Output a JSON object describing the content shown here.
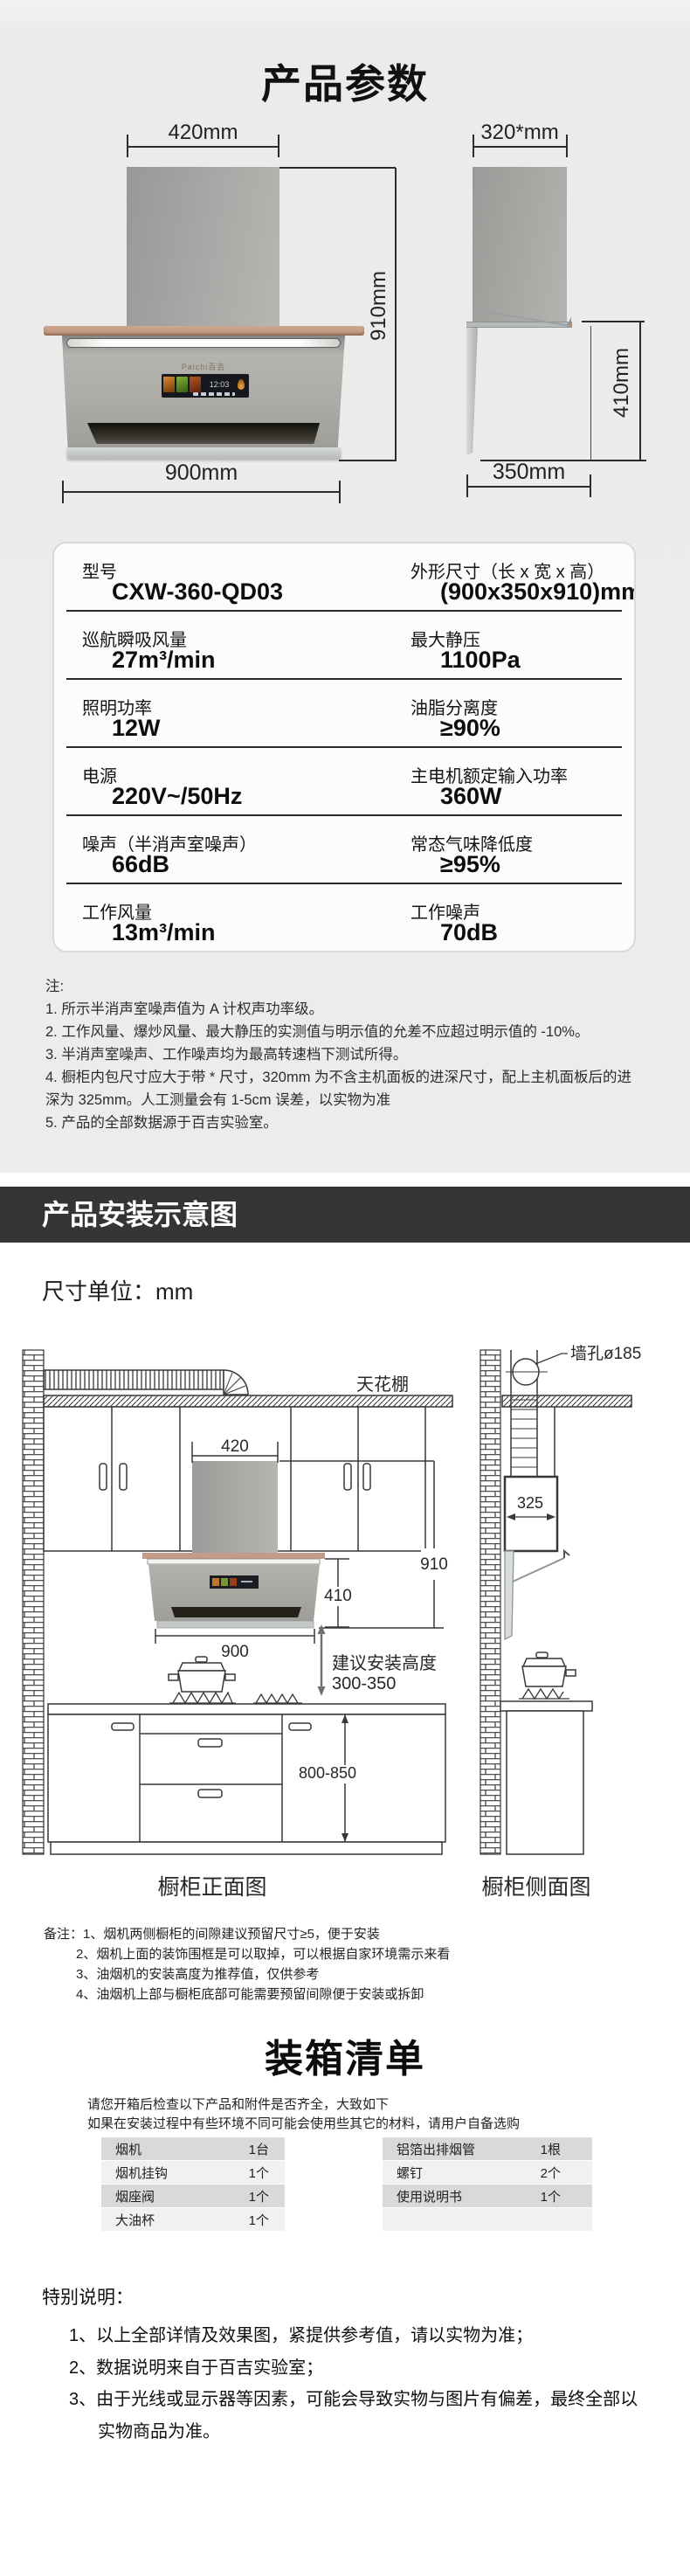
{
  "params": {
    "title": "产品参数",
    "front": {
      "top_dim": "420mm",
      "height_dim": "910mm",
      "width_dim": "900mm",
      "brand": "Paichi百吉",
      "clock": "12:03"
    },
    "side": {
      "top_dim": "320*mm",
      "height_dim": "410mm",
      "depth_dim": "350mm"
    },
    "table": {
      "rows": [
        {
          "ll": "型号",
          "lv": "CXW-360-QD03",
          "rl": "外形尺寸（长 x 宽 x 高）",
          "rv": "(900x350x910)mm"
        },
        {
          "ll": "巡航瞬吸风量",
          "lv": "27m³/min",
          "rl": "最大静压",
          "rv": "1100Pa"
        },
        {
          "ll": "照明功率",
          "lv": "12W",
          "rl": "油脂分离度",
          "rv": "≥90%"
        },
        {
          "ll": "电源",
          "lv": "220V~/50Hz",
          "rl": "主电机额定输入功率",
          "rv": "360W"
        },
        {
          "ll": "噪声（半消声室噪声）",
          "lv": "66dB",
          "rl": "常态气味降低度",
          "rv": "≥95%"
        },
        {
          "ll": "工作风量",
          "lv": "13m³/min",
          "rl": "工作噪声",
          "rv": "70dB"
        }
      ]
    },
    "notes_title": "注:",
    "notes": [
      "1. 所示半消声室噪声值为 A 计权声功率级。",
      "2. 工作风量、爆炒风量、最大静压的实测值与明示值的允差不应超过明示值的 -10%。",
      "3. 半消声室噪声、工作噪声均为最高转速档下测试所得。",
      "4. 橱柜内包尺寸应大于带 * 尺寸，320mm 为不含主机面板的进深尺寸，配上主机面板后的进深为 325mm。人工测量会有 1-5cm 误差，以实物为准",
      "5. 产品的全部数据源于百吉实验室。"
    ]
  },
  "install": {
    "banner": "产品安装示意图",
    "unit": "尺寸单位：mm",
    "ceiling": "天花棚",
    "wall_hole": "墙孔ø185",
    "duct_w": "420",
    "hood_h": "910",
    "body_h": "410",
    "hood_w": "900",
    "advise1": "建议安装高度",
    "advise2": "300-350",
    "counter_h": "800-850",
    "depth": "325",
    "front_caption": "橱柜正面图",
    "side_caption": "橱柜侧面图",
    "remarks_items": [
      "备注：1、烟机两侧橱柜的间隙建议预留尺寸≥5，便于安装",
      "2、烟机上面的装饰围框是可以取掉，可以根据自家环境需示来看",
      "3、油烟机的安装高度为推荐值，仅供参考",
      "4、油烟机上部与橱柜底部可能需要预留间隙便于安装或拆卸"
    ]
  },
  "packing": {
    "title": "装箱清单",
    "intro1": "请您开箱后检查以下产品和附件是否齐全，大致如下",
    "intro2": "如果在安装过程中有些环境不同可能会使用些其它的材料，请用户自备选购",
    "left_rows": [
      {
        "name": "烟机",
        "qty": "1台"
      },
      {
        "name": "烟机挂钩",
        "qty": "1个"
      },
      {
        "name": "烟座阀",
        "qty": "1个"
      },
      {
        "name": "大油杯",
        "qty": "1个"
      }
    ],
    "right_rows": [
      {
        "name": "铝箔出排烟管",
        "qty": "1根"
      },
      {
        "name": "螺钉",
        "qty": "2个"
      },
      {
        "name": "使用说明书",
        "qty": "1个"
      },
      {
        "name": "",
        "qty": ""
      }
    ]
  },
  "special": {
    "title": "特别说明：",
    "items": [
      "1、以上全部详情及效果图，紧提供参考值，请以实物为准；",
      "2、数据说明来自于百吉实验室；",
      "3、由于光线或显示器等因素，可能会导致实物与图片有偏差，最终全部以",
      "实物商品为准。"
    ]
  }
}
